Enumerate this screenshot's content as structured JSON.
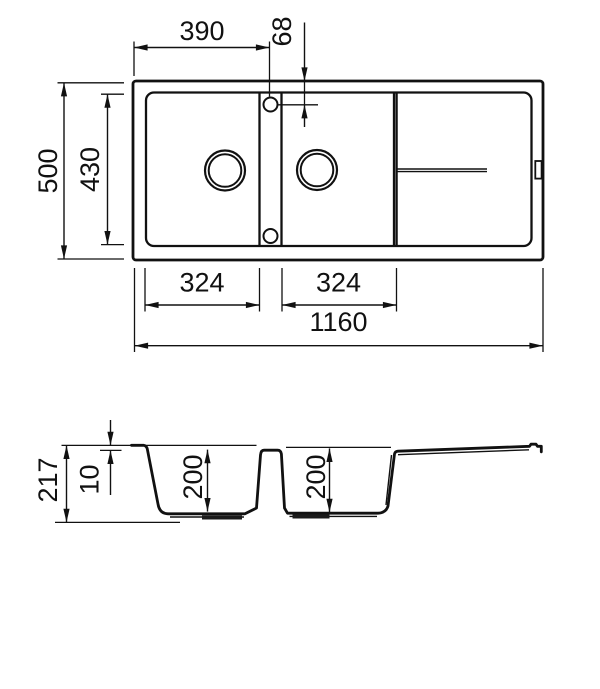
{
  "colors": {
    "line": "#111111",
    "background": "#ffffff"
  },
  "top_view": {
    "dims": {
      "left_to_tap_center": "390",
      "tap_center_from_top": "68",
      "overall_depth": "500",
      "inner_depth": "430",
      "bowl1_width": "324",
      "bowl2_width": "324",
      "overall_length": "1160"
    }
  },
  "section_view": {
    "dims": {
      "overall_height": "217",
      "rim_step": "10",
      "bowl1_depth": "200",
      "bowl2_depth": "200"
    }
  }
}
